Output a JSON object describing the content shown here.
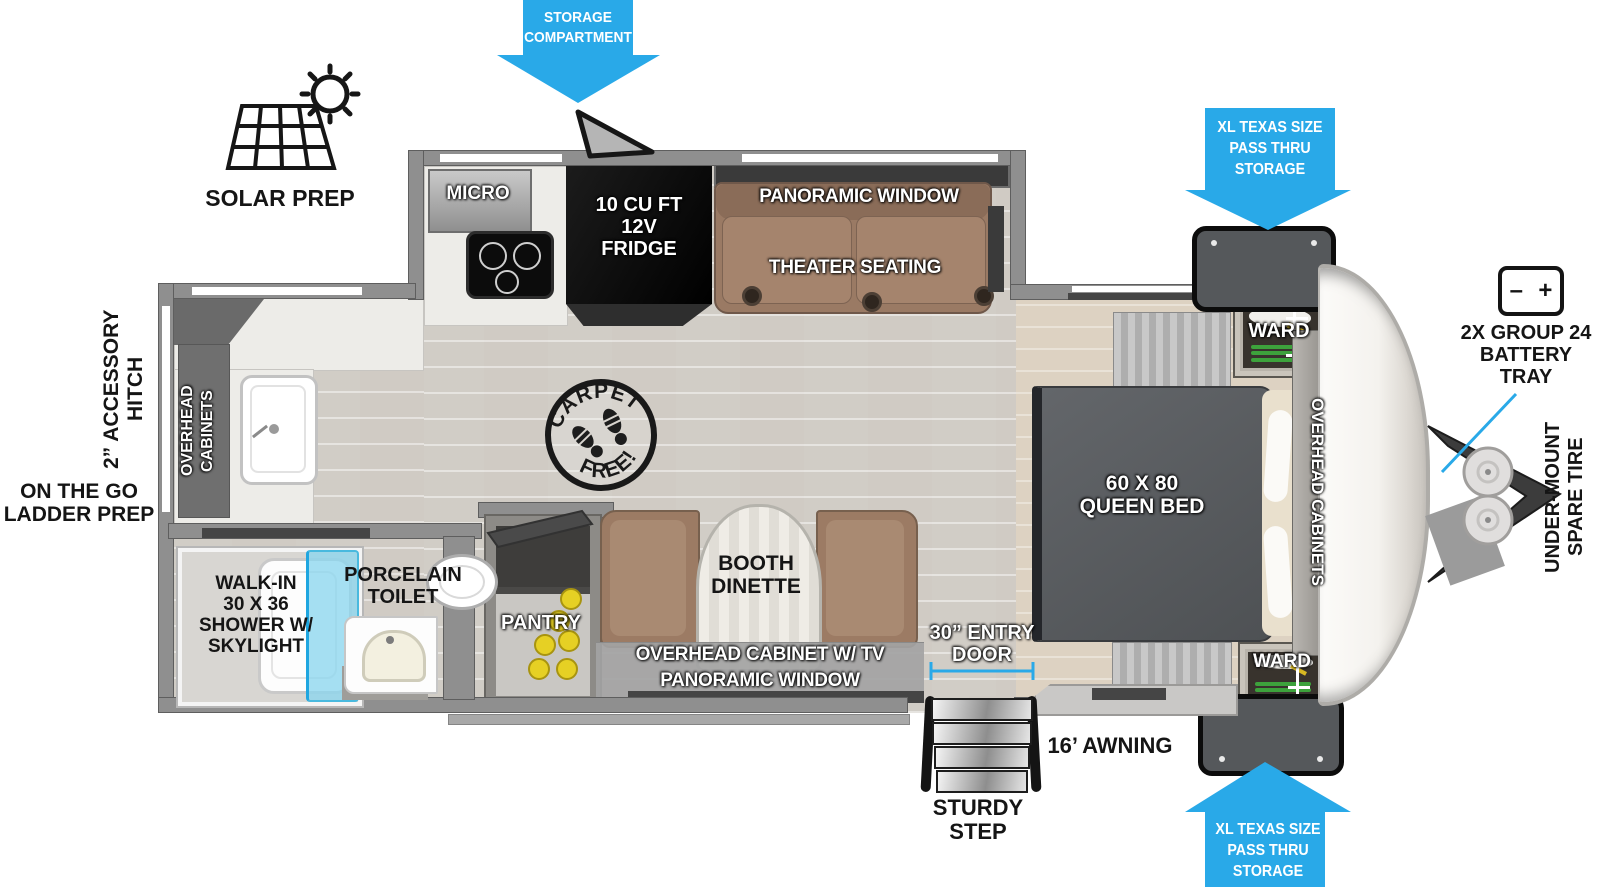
{
  "title": "Travel trailer floorplan diagram",
  "colors": {
    "callout_blue": "#29a9e8",
    "wall_gray": "#8f8f8f",
    "sofa_brown": "#9a7a64",
    "bed_gray": "#55585a",
    "shower_glass_blue": "#8cd6ee"
  },
  "callouts": {
    "storage_compartment": "STORAGE\nCOMPARTMENT",
    "pass_thru_top": "XL TEXAS SIZE\nPASS THRU\nSTORAGE",
    "pass_thru_bottom": "XL TEXAS SIZE\nPASS THRU\nSTORAGE",
    "solar_prep": "SOLAR PREP",
    "battery_tray": "2X GROUP 24\nBATTERY\nTRAY",
    "battery_minus": "–",
    "battery_plus": "+",
    "under_mount_spare_tire": "UNDER-MOUNT\nSPARE TIRE",
    "accessory_hitch": "2” ACCESSORY\nHITCH",
    "ladder_prep": "ON THE GO\nLADDER PREP",
    "entry_door": "30” ENTRY\nDOOR",
    "awning": "16’ AWNING",
    "sturdy_step": "STURDY\nSTEP"
  },
  "interior": {
    "micro": "MICRO",
    "fridge": "10 CU FT\n12V\nFRIDGE",
    "panoramic_window_top": "PANORAMIC WINDOW",
    "theater_seating": "THEATER SEATING",
    "ward_top": "WARD",
    "ward_bottom": "WARD",
    "queen_bed": "60 X 80\nQUEEN BED",
    "overhead_cabinets_bedroom": "OVERHEAD CABINETS",
    "carpet_free_top": "CARPET",
    "carpet_free_bottom": "FREE!",
    "booth_dinette": "BOOTH\nDINETTE",
    "overhead_cabinet_tv": "OVERHEAD CABINET W/ TV",
    "panoramic_window_bottom": "PANORAMIC WINDOW",
    "pantry": "PANTRY",
    "porcelain_toilet": "PORCELAIN\nTOILET",
    "shower": "WALK-IN\n30 X 36\nSHOWER W/\nSKYLIGHT",
    "overhead_cabinets_rear": "OVERHEAD\nCABINETS"
  }
}
